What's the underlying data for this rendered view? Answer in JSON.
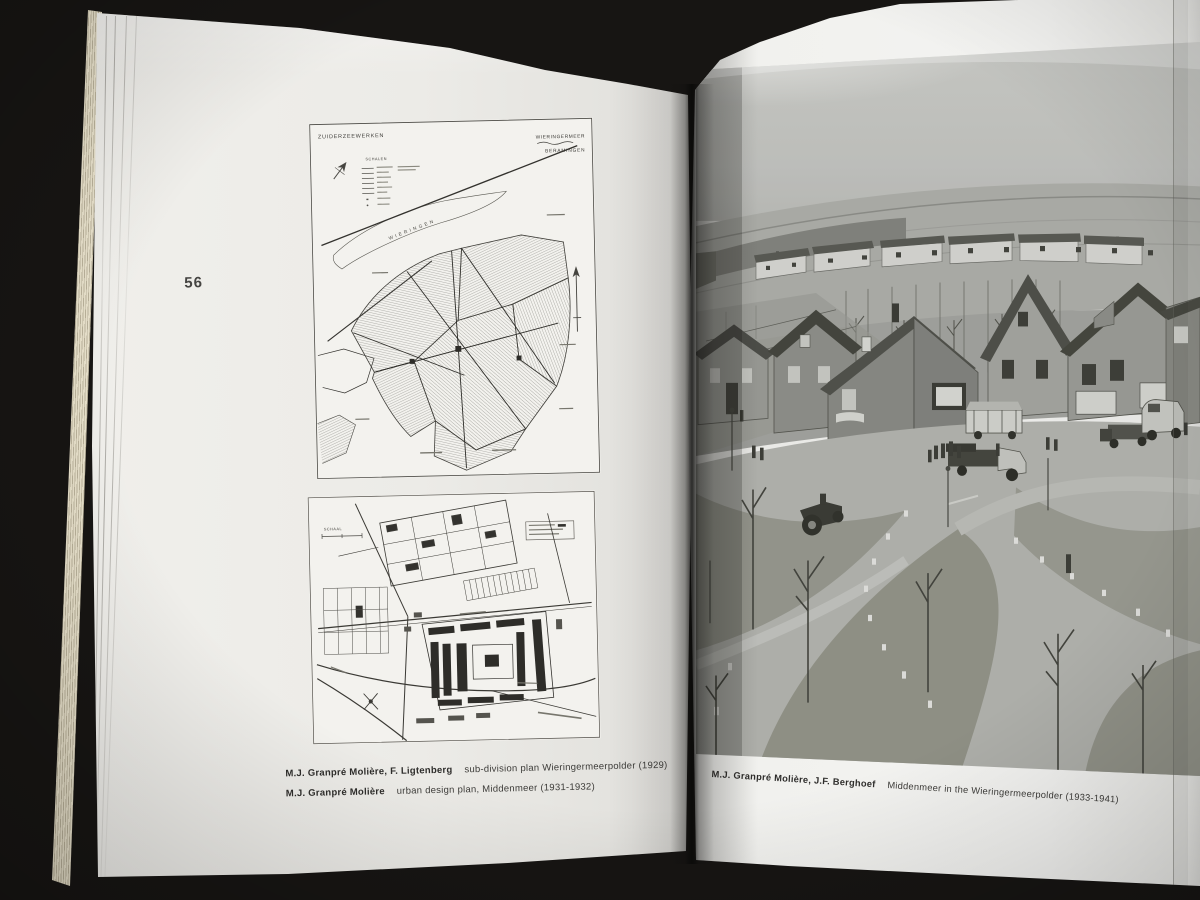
{
  "book": {
    "left_page": {
      "page_number": "56",
      "top_map": {
        "corner_label": "ZUIDERZEEWERKEN",
        "region_label_line1": "WIERINGERMEER",
        "region_label_line2": "BERAMINGEN",
        "legend_title": "SCHALEN",
        "island_label": "WIERINGEN"
      },
      "bottom_map": {
        "legend_title": "SCHAAL"
      },
      "captions": [
        {
          "authors": "M.J. Granpré Molière, F. Ligtenberg",
          "title": "sub-division plan Wieringermeerpolder (1929)"
        },
        {
          "authors": "M.J. Granpré Molière",
          "title": "urban design plan, Middenmeer (1931-1932)"
        }
      ]
    },
    "right_page": {
      "caption": {
        "authors": "M.J. Granpré Molière, J.F. Berghoef",
        "title": "Middenmeer in the Wieringermeerpolder (1933-1941)"
      }
    }
  },
  "colors": {
    "background": "#171513",
    "left_page": "#ecebe7",
    "right_page": "#f1f1ee",
    "page_edge": "#e9e2cc",
    "ink": "#2e2d2b",
    "photo_sky": "#c7c8c4",
    "photo_pavement": "#b1b2ad",
    "photo_dark": "#4c4d48"
  }
}
